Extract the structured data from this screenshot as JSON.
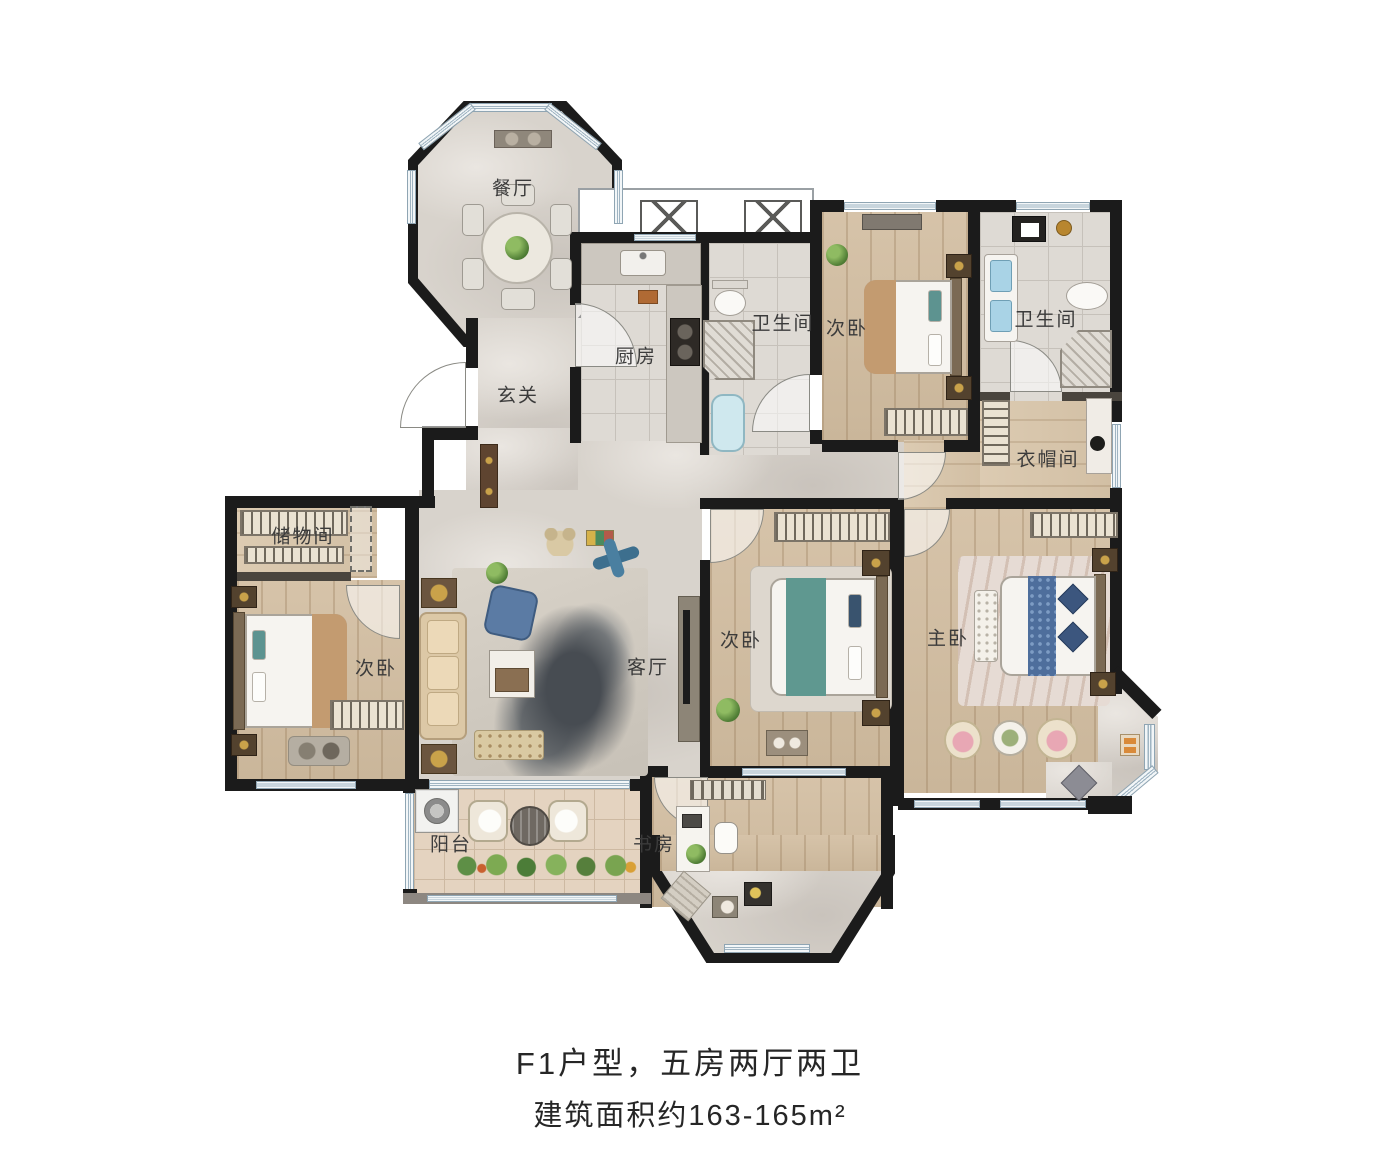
{
  "caption": {
    "line1": "F1户型，五房两厅两卫",
    "line2": "建筑面积约163-165m²"
  },
  "rooms": {
    "dining": {
      "label": "餐厅"
    },
    "entry": {
      "label": "玄关"
    },
    "kitchen": {
      "label": "厨房"
    },
    "bath1": {
      "label": "卫生间"
    },
    "bedroom1": {
      "label": "次卧"
    },
    "bath2": {
      "label": "卫生间"
    },
    "closet": {
      "label": "衣帽间"
    },
    "storage": {
      "label": "储物间"
    },
    "bedroom2": {
      "label": "次卧"
    },
    "living": {
      "label": "客厅"
    },
    "bedroom3": {
      "label": "次卧"
    },
    "master": {
      "label": "主卧"
    },
    "balcony": {
      "label": "阳台"
    },
    "study": {
      "label": "书房"
    }
  },
  "colors": {
    "wall": "#1b1b1b",
    "marble_floor": "#d8d3cc",
    "wood_floor": "#cfbda2",
    "tile_floor": "#dedad4",
    "balcony_tile": "#e4d3c0",
    "window": "#9fb4c2",
    "accent_tan": "#c39b70",
    "accent_teal": "#5f9890",
    "accent_blue": "#4e6e9c"
  }
}
